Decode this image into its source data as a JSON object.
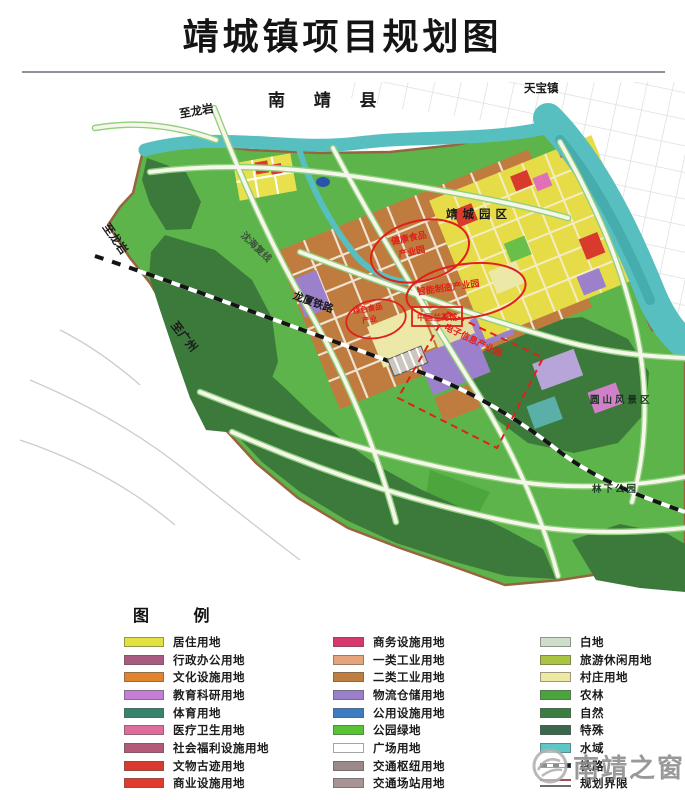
{
  "title": "靖城镇项目规划图",
  "map": {
    "labels": {
      "county": "南  靖  县",
      "tianbao": "天宝镇",
      "to_longyan_top": "至龙岩",
      "to_longyan_left": "至龙岩",
      "to_guangzhou": "至广州",
      "shenhai_expwy": "沈海复线",
      "longxia_railway": "龙厦铁路",
      "jingcheng_park": "靖城园区",
      "yuanshan_scenic": "圆山风景区",
      "linxia_park": "林下公园"
    },
    "projects": {
      "p1_line1": "健康食品",
      "p1_line2": "产业园",
      "p2": "智能制造产业园",
      "p3_line1": "绿色食品",
      "p3_line2": "产业",
      "p4": "中国兰花城",
      "p5": "电子信息产业园"
    },
    "colors": {
      "land_green": "#5cb44b",
      "forest_green": "#3c7a3c",
      "water_teal": "#58bfc0",
      "industry_orange": "#c07c3e",
      "residential_yellow": "#e6dc48",
      "annotation_red": "#e0201a",
      "boundary_brown": "#96653f"
    }
  },
  "legend": {
    "title": "图  例",
    "columns": [
      [
        {
          "label": "居住用地",
          "color": "#e3e13f"
        },
        {
          "label": "行政办公用地",
          "color": "#aa5a80"
        },
        {
          "label": "文化设施用地",
          "color": "#e08430"
        },
        {
          "label": "教育科研用地",
          "color": "#c57fd2"
        },
        {
          "label": "体育用地",
          "color": "#37836e"
        },
        {
          "label": "医疗卫生用地",
          "color": "#df6d9c"
        },
        {
          "label": "社会福利设施用地",
          "color": "#b25a78"
        },
        {
          "label": "文物古迹用地",
          "color": "#d93a30"
        },
        {
          "label": "商业设施用地",
          "color": "#e23b2e"
        }
      ],
      [
        {
          "label": "商务设施用地",
          "color": "#d6376e"
        },
        {
          "label": "一类工业用地",
          "color": "#e5a47c"
        },
        {
          "label": "二类工业用地",
          "color": "#bf7d40"
        },
        {
          "label": "物流仓储用地",
          "color": "#9a7fca"
        },
        {
          "label": "公用设施用地",
          "color": "#3d7cc2"
        },
        {
          "label": "公园绿地",
          "color": "#58c235"
        },
        {
          "label": "广场用地",
          "color": "#ffffff"
        },
        {
          "label": "交通枢纽用地",
          "color": "#9b8a89"
        },
        {
          "label": "交通场站用地",
          "color": "#a89494"
        }
      ],
      [
        {
          "label": "白地",
          "color": "#cfdecb"
        },
        {
          "label": "旅游休闲用地",
          "color": "#a8c440"
        },
        {
          "label": "村庄用地",
          "color": "#ede9a2"
        },
        {
          "label": "农林",
          "color": "#4aa33c"
        },
        {
          "label": "自然",
          "color": "#3c7e41"
        },
        {
          "label": "特殊",
          "color": "#39684d"
        },
        {
          "label": "水域",
          "color": "#5fc6c6"
        },
        {
          "label": "铁路",
          "color": "#222222",
          "type": "rail"
        },
        {
          "label": "规划界限",
          "color": "#9c5050",
          "type": "bound"
        }
      ]
    ]
  },
  "watermark": {
    "text": "南靖之窗"
  }
}
